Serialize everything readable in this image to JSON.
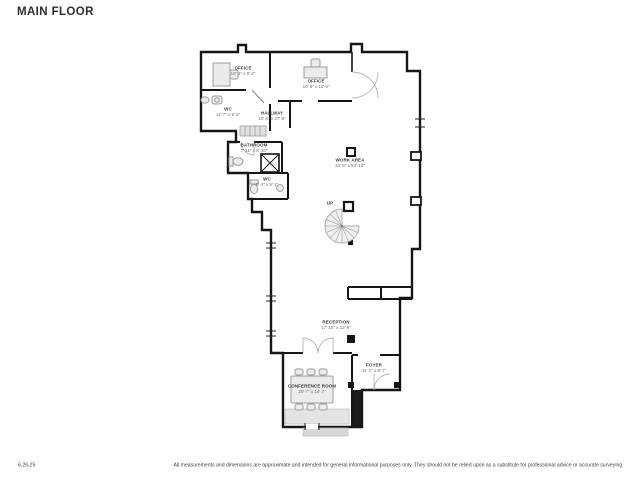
{
  "page": {
    "title": "MAIN FLOOR"
  },
  "plan": {
    "wall_color": "#161616",
    "furniture_color": "#9c9c9c",
    "label_color": "#3d3d3d",
    "rooms": [
      {
        "id": "office-left",
        "name": "OFFICE",
        "dims": "10' 4\" x 9' 2\"",
        "x": 243,
        "y": 71
      },
      {
        "id": "office-right",
        "name": "OFFICE",
        "dims": "10' 6\" x 11' 6\"",
        "x": 316,
        "y": 84
      },
      {
        "id": "wc-1",
        "name": "WC",
        "dims": "11' 7\" x 9' 5\"",
        "x": 228,
        "y": 112
      },
      {
        "id": "hallway",
        "name": "HALLWAY",
        "dims": "10' 6\" x 27' 9\"",
        "x": 272,
        "y": 116
      },
      {
        "id": "bathroom",
        "name": "BATHROOM",
        "dims": "7' 11\" x 8' 10\"",
        "x": 254,
        "y": 148
      },
      {
        "id": "wc-2",
        "name": "WC",
        "dims": "8' 4\" x 5' 1\"",
        "x": 267,
        "y": 182
      },
      {
        "id": "work-area",
        "name": "WORK AREA",
        "dims": "34' 8\" x 54' 10\"",
        "x": 350,
        "y": 163
      },
      {
        "id": "stairs-up",
        "name": "UP",
        "dims": "",
        "x": 330,
        "y": 203
      },
      {
        "id": "reception",
        "name": "RECEPTION",
        "dims": "17' 10\" x 12' 9\"",
        "x": 336,
        "y": 325
      },
      {
        "id": "foyer",
        "name": "FOYER",
        "dims": "11' 1\" x 9' 7\"",
        "x": 374,
        "y": 368
      },
      {
        "id": "conference-room",
        "name": "CONFERENCE ROOM",
        "dims": "20' 7\" x 14' 7\"",
        "x": 312,
        "y": 389
      }
    ]
  },
  "footer": {
    "date": "6.26.25",
    "disclaimer": "All measurements and dimensions are approximate and intended for general informational purposes only. They should not be relied upon as a substitute for professional advice or accurate surveying."
  }
}
